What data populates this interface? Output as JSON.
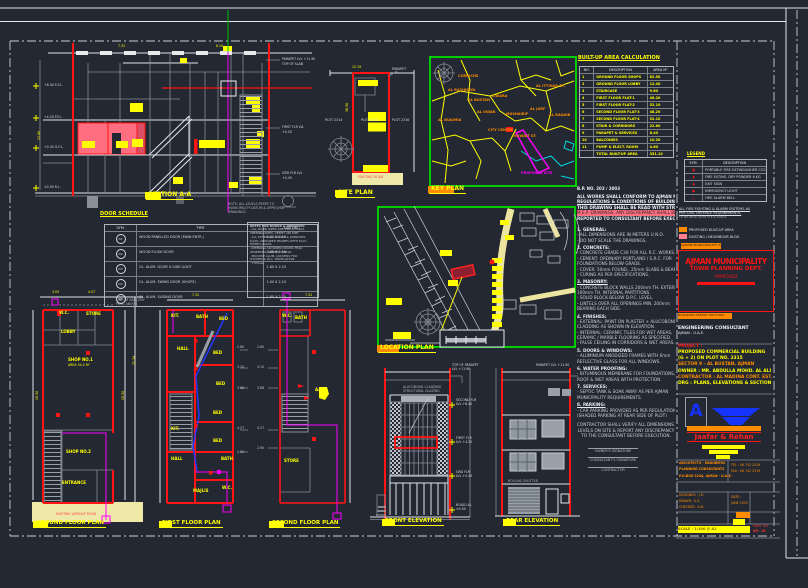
{
  "colors": {
    "background": "#232832",
    "cad_red": "#ff1414",
    "cad_yellow": "#ffff00",
    "cad_magenta": "#ff00ff",
    "cad_green": "#00cc00",
    "cad_cyan": "#00d8e0",
    "cad_orange": "#ff8c00",
    "cad_blue": "#2438ff",
    "road_fill": "#efe9a8"
  },
  "titles": {
    "section": "SECTION A-A",
    "site": "SITE PLAN",
    "key": "KEY PLAN",
    "location": "LOCATION PLAN",
    "ground": "GROUND FLOOR PLAN",
    "first": "FIRST FLOOR PLAN",
    "second": "SECOND FLOOR PLAN",
    "front": "FRONT ELEVATION",
    "rear": "REAR ELEVATION",
    "door_schedule": "DOOR SCHEDULE",
    "area_calc": "BUILT-UP AREA CALCULATION",
    "legend": "LEGEND"
  },
  "door_schedule": {
    "headers": [
      "SYM.",
      "TYPE",
      "SIZE (M)"
    ],
    "rows": [
      {
        "sym": "D1",
        "type": "WOOD PANELLED DOOR (MAIN ENTR.)",
        "size": "1.00 X 2.10"
      },
      {
        "sym": "D2",
        "type": "WOOD FLUSH DOOR",
        "size": "0.90 X 2.10"
      },
      {
        "sym": "D3",
        "type": "GL. ALUM. DOOR & SIDE LIGHT",
        "size": "1.80 X 2.10"
      },
      {
        "sym": "D4",
        "type": "GL. ALUM. SWING DOOR (SHOPS)",
        "size": "1.00 X 2.10"
      },
      {
        "sym": "D5",
        "type": "GL. ALUM. SLIDING DOOR",
        "size": "1.80 X 2.10"
      }
    ]
  },
  "door_notes": {
    "lines": [
      {
        "t": "NOTES FOR DOORS & WINDOWS:",
        "cls": "h"
      },
      {
        "t": "- ALL DOOR SIZES ARE STRUCTURAL",
        "cls": ""
      },
      {
        "t": "  OPENING SIZES. VERIFY ON SITE.",
        "cls": ""
      },
      {
        "t": "- ALL EXTERNAL DOORS & WINDOWS",
        "cls": ""
      },
      {
        "t": "  ALUM. ANODIZED FRAMES WITH 6mm",
        "cls": ""
      },
      {
        "t": "  TINTED GLASS.",
        "cls": ""
      },
      {
        "t": "- INTERNAL WOODEN DOORS TEAK",
        "cls": ""
      },
      {
        "t": "  VENEERED, PAINTED FINISH.",
        "cls": ""
      },
      {
        "t": "- PROVIDE ALUM. LOUVERS FOR",
        "cls": ""
      },
      {
        "t": "  KITCHEN & W.C. VENTILATION.",
        "cls": ""
      },
      {
        "t": "        - TYPICAL",
        "cls": ""
      }
    ]
  },
  "area_table": {
    "headers": [
      "NO.",
      "DESCRIPTION",
      "AREA M²"
    ],
    "rows": [
      {
        "no": "1",
        "desc": "GROUND FLOOR SHOPS",
        "area": "82.50"
      },
      {
        "no": "2",
        "desc": "GROUND FLOOR LOBBY",
        "area": "12.40"
      },
      {
        "no": "3",
        "desc": "STAIRCASE",
        "area": "9.80"
      },
      {
        "no": "4",
        "desc": "FIRST FLOOR FLAT-1",
        "area": "48.20"
      },
      {
        "no": "5",
        "desc": "FIRST FLOOR FLAT-2",
        "area": "52.10"
      },
      {
        "no": "6",
        "desc": "SECOND FLOOR FLAT-3",
        "area": "48.20"
      },
      {
        "no": "7",
        "desc": "SECOND FLOOR FLAT-4",
        "area": "52.10"
      },
      {
        "no": "8",
        "desc": "STAIR & CORRIDORS",
        "area": "22.60"
      },
      {
        "no": "9",
        "desc": "PARAPET & SERVICES",
        "area": "8.40"
      },
      {
        "no": "10",
        "desc": "BALCONIES",
        "area": "10.20"
      },
      {
        "no": "11",
        "desc": "PUMP & ELECT. ROOM",
        "area": "4.60"
      },
      {
        "no": "",
        "desc": "TOTAL BUILT-UP AREA",
        "area": "351.10"
      }
    ]
  },
  "legend": {
    "headers": [
      "SYM.",
      "DESCRIPTION"
    ],
    "rows": [
      {
        "sym": "▣",
        "desc": "PORTABLE FIRE EXTINGUISHER CO2"
      },
      {
        "sym": "▮",
        "desc": "FIRE EXTING. DRY POWDER 6 KG"
      },
      {
        "sym": "◆",
        "desc": "EXIT SIGN"
      },
      {
        "sym": "●",
        "desc": "EMERGENCY LIGHT"
      },
      {
        "sym": "△",
        "desc": "FIRE ALARM BELL"
      }
    ]
  },
  "notes": {
    "bp": "B.P. NO. 203 / 2003",
    "lines": [
      {
        "t": "ALL WORKS SHALL CONFORM TO AJMAN MUNICIPALITY",
        "cls": "h"
      },
      {
        "t": "REGULATIONS & CONDITIONS OF BUILDING PERMIT.",
        "cls": "h"
      },
      {
        "t": "THIS DRAWING SHALL BE READ WITH STRUCTURAL &",
        "cls": "h"
      },
      {
        "t": "M.E.P. DRAWINGS. ANY DISCREPANCY SHALL BE",
        "cls": "mark"
      },
      {
        "t": "REPORTED TO CONSULTANT BEFORE EXECUTION.",
        "cls": "h"
      },
      {
        "t": "",
        "cls": "sp"
      },
      {
        "t": "1. GENERAL:",
        "cls": "n"
      },
      {
        "t": "- ALL DIMENSIONS ARE IN METERS U.N.O.",
        "cls": ""
      },
      {
        "t": "- DO NOT SCALE THE DRAWINGS.",
        "cls": ""
      },
      {
        "t": "2. CONCRETE:",
        "cls": "n"
      },
      {
        "t": "- CONCRETE GRADE C30 FOR ALL R.C. WORKS.",
        "cls": ""
      },
      {
        "t": "- CEMENT: ORDINARY PORTLAND / S.R.C. FOR",
        "cls": ""
      },
      {
        "t": "  FOUNDATIONS BELOW GRADE.",
        "cls": ""
      },
      {
        "t": "- COVER: 50mm FOUND., 25mm SLABS & BEAMS.",
        "cls": ""
      },
      {
        "t": "- CURING AS PER SPECIFICATIONS.",
        "cls": ""
      },
      {
        "t": "3. MASONRY:",
        "cls": "n"
      },
      {
        "t": "- CONCRETE BLOCK WALLS 200mm TH. EXTERNAL,",
        "cls": ""
      },
      {
        "t": "  100mm TH. INTERNAL PARTITIONS.",
        "cls": ""
      },
      {
        "t": "- SOLID BLOCK BELOW D.P.C. LEVEL.",
        "cls": ""
      },
      {
        "t": "- LINTELS OVER ALL OPENINGS MIN. 200mm",
        "cls": ""
      },
      {
        "t": "  BEARING EACH SIDE.",
        "cls": ""
      },
      {
        "t": "4. FINISHES:",
        "cls": "n"
      },
      {
        "t": "- EXTERNAL: PAINT ON PLASTER + ALUCOBOND",
        "cls": ""
      },
      {
        "t": "  CLADDING AS SHOWN IN ELEVATION.",
        "cls": ""
      },
      {
        "t": "- INTERNAL: CERAMIC TILES FOR WET AREAS,",
        "cls": ""
      },
      {
        "t": "  CERAMIC / MARBLE FLOORING AS SPECIFIED.",
        "cls": ""
      },
      {
        "t": "- FALSE CEILING IN CORRIDORS & WET AREAS.",
        "cls": ""
      },
      {
        "t": "5. DOORS & WINDOWS:",
        "cls": "n"
      },
      {
        "t": "- ALUMINIUM ANODIZED FRAMES WITH 6mm",
        "cls": ""
      },
      {
        "t": "  REFLECTIVE GLASS FOR ALL WINDOWS.",
        "cls": ""
      },
      {
        "t": "6. WATER PROOFING:",
        "cls": "n"
      },
      {
        "t": "- BITUMINOUS MEMBRANE FOR FOUNDATIONS,",
        "cls": ""
      },
      {
        "t": "  ROOF & WET AREAS WITH PROTECTION.",
        "cls": ""
      },
      {
        "t": "7. SERVICES:",
        "cls": "n"
      },
      {
        "t": "- SEPTIC TANK & SOAK AWAY AS PER AJMAN",
        "cls": ""
      },
      {
        "t": "  MUNICIPALITY REQUIREMENTS.",
        "cls": ""
      },
      {
        "t": "8. PARKING:",
        "cls": "n"
      },
      {
        "t": "- CAR PARKING PROVIDED AS PER REGULATIONS.",
        "cls": ""
      },
      {
        "t": "  (SHADED PARKING AT REAR SIDE OF PLOT)",
        "cls": ""
      },
      {
        "t": "",
        "cls": "sp"
      },
      {
        "t": "CONTRACTOR SHALL VERIFY ALL DIMENSIONS &",
        "cls": "c"
      },
      {
        "t": "LEVELS ON SITE & REPORT ANY DISCREPANCY",
        "cls": "c"
      },
      {
        "t": "TO THE CONSULTANT BEFORE EXECUTION.",
        "cls": "c"
      }
    ]
  },
  "signature": {
    "lines": [
      "OWNER'S SIGNATURE",
      "CONSULTANT'S SIGNATURE",
      "CONTRACTOR"
    ]
  },
  "key_labels": [
    {
      "x": 448,
      "y": 88,
      "t": "AL RASHIDIYA"
    },
    {
      "x": 468,
      "y": 98,
      "t": "AL BUSTAN"
    },
    {
      "x": 492,
      "y": 94,
      "t": "LIWARA"
    },
    {
      "x": 477,
      "y": 110,
      "t": "AL OWAN"
    },
    {
      "x": 438,
      "y": 118,
      "t": "AL NUAIMIA"
    },
    {
      "x": 506,
      "y": 112,
      "t": "MUSHAIRIF"
    },
    {
      "x": 530,
      "y": 107,
      "t": "AL JURF"
    },
    {
      "x": 549,
      "y": 113,
      "t": "AL RAQAIB"
    },
    {
      "x": 488,
      "y": 128,
      "t": "CITY CENTRE"
    },
    {
      "x": 514,
      "y": 134,
      "t": "KUWAIT ST."
    },
    {
      "x": 536,
      "y": 84,
      "t": "AL ITTIHAD ST."
    },
    {
      "x": 458,
      "y": 74,
      "t": "CORNICHE"
    },
    {
      "x": 521,
      "y": 171,
      "t": "PROPOSED SITE",
      "c": "#ff00ff"
    }
  ],
  "title_block": {
    "note_lines": [
      {
        "t": "ALL FIRE FIGHTING & ALARM SYSTEMS AS",
        "cls": "h"
      },
      {
        "t": "PER CIVIL DEFENCE REQUIREMENTS.",
        "cls": "h"
      },
      {
        "t": "TO BE READ WITH M.E.P. DWGS.",
        "cls": "dim"
      }
    ],
    "swatches": [
      {
        "label": "PROPOSED BUILT-UP AREA",
        "bg": "#ff8c00"
      },
      {
        "label": "EXISTING / NEIGHBOUR BLDG.",
        "bg": "#ff8090"
      }
    ],
    "approval": "AJMAN MUNICIPALITY APPROVAL",
    "stamp": {
      "l1": "AJMAN MUNICIPALITY",
      "l2": "TOWN PLANNING DEPT.",
      "l3": "APPROVED"
    },
    "approval2": "BUILDING PERMIT SECTION",
    "firm": {
      "l1": "ENGINEERING CONSULTANT",
      "l2": "AJMAN - U.A.E."
    },
    "project_lines": [
      {
        "t": "PROJECT :",
        "c": "#ff2020"
      },
      {
        "t": "PROPOSED COMMERCIAL BUILDING",
        "c": "#ffff00"
      },
      {
        "t": "(G + 2) ON PLOT NO. 2315",
        "c": "#ffff00"
      },
      {
        "t": "SECTOR 9 - AL BUSTAN, AJMAN",
        "c": "#ff8c00"
      },
      {
        "t": "OWNER : MR. ABDULLA MOHD. AL ALI",
        "c": "#ffff00"
      },
      {
        "t": "CONTRACTOR : AL MADINA CONT. EST.",
        "c": "#ff8c00"
      },
      {
        "t": "DRG : PLANS, ELEVATIONS & SECTION",
        "c": "#ffff00"
      }
    ],
    "logo_letter": "A",
    "name": "Jaafar & Rehan",
    "scale_text": "SCALE : 1:100 @ A1"
  },
  "micro_texts": [
    {
      "x": 282,
      "y": 58,
      "t": "PARAPET LVL +11.90",
      "cls": "f3"
    },
    {
      "x": 282,
      "y": 63,
      "t": "TOP OF SLAB",
      "cls": "f3"
    },
    {
      "x": 282,
      "y": 126,
      "t": "FIRST FLR LVL",
      "cls": "f3"
    },
    {
      "x": 282,
      "y": 131,
      "t": "+4.20",
      "cls": "f3"
    },
    {
      "x": 282,
      "y": 172,
      "t": "GRD FLR LVL",
      "cls": "f3"
    },
    {
      "x": 282,
      "y": 177,
      "t": "+0.45",
      "cls": "f3"
    },
    {
      "x": 44,
      "y": 84,
      "t": "+8.40 S.F.L.",
      "cls": "f3"
    },
    {
      "x": 44,
      "y": 116,
      "t": "+4.20 F.F.L.",
      "cls": "f3"
    },
    {
      "x": 44,
      "y": 146,
      "t": "+0.45 G.F.L.",
      "cls": "f3"
    },
    {
      "x": 44,
      "y": 186,
      "t": "±0.00 R.L.",
      "cls": "f3"
    },
    {
      "x": 228,
      "y": 203,
      "t": "NOTE: ALL LEVELS REFER TO",
      "c": "#aeb4bc",
      "cls": "f3"
    },
    {
      "x": 228,
      "y": 207,
      "t": "MUNICIPALITY DATUM & APPROVED",
      "c": "#aeb4bc",
      "cls": "f3"
    },
    {
      "x": 228,
      "y": 211,
      "t": "DRAWINGS.",
      "c": "#aeb4bc",
      "cls": "f3"
    },
    {
      "x": 118,
      "y": 45,
      "t": "7.32",
      "c": "#ffff00",
      "cls": "f3"
    },
    {
      "x": 216,
      "y": 45,
      "t": "6.10",
      "c": "#ffff00",
      "cls": "f3"
    },
    {
      "x": 38,
      "y": 140,
      "t": "12.60",
      "c": "#ffff00",
      "cls": "f3 rot"
    },
    {
      "x": 325,
      "y": 119,
      "t": "PLOT 2314",
      "cls": "f3"
    },
    {
      "x": 361,
      "y": 119,
      "t": "PLOT 2315",
      "cls": "f3"
    },
    {
      "x": 392,
      "y": 119,
      "t": "PLOT 2316",
      "cls": "f3"
    },
    {
      "x": 392,
      "y": 68,
      "t": "PARAPET",
      "cls": "f3"
    },
    {
      "x": 358,
      "y": 176,
      "t": "EXISTING ROAD",
      "c": "#ff4040",
      "cls": "f3"
    },
    {
      "x": 352,
      "y": 66,
      "t": "12.19",
      "c": "#ffff00",
      "cls": "f3"
    },
    {
      "x": 346,
      "y": 112,
      "t": "36.58",
      "c": "#ffff00",
      "cls": "f3 rot"
    },
    {
      "x": 52,
      "y": 291,
      "t": "3.05",
      "c": "#ffff00",
      "cls": "f3"
    },
    {
      "x": 88,
      "y": 291,
      "t": "4.57",
      "c": "#ffff00",
      "cls": "f3"
    },
    {
      "x": 59,
      "y": 311,
      "t": "W.C.",
      "c": "#ffff00",
      "cls": "b"
    },
    {
      "x": 86,
      "y": 312,
      "t": "STORE",
      "c": "#ffff00",
      "cls": "b"
    },
    {
      "x": 61,
      "y": 330,
      "t": "LOBBY",
      "c": "#ffff00",
      "cls": "b"
    },
    {
      "x": 68,
      "y": 358,
      "t": "SHOP NO.1",
      "c": "#ffff00",
      "cls": "b"
    },
    {
      "x": 68,
      "y": 364,
      "t": "AREA 54.0 M²",
      "c": "#ffff00",
      "cls": "f3"
    },
    {
      "x": 66,
      "y": 450,
      "t": "SHOP NO.2",
      "c": "#ffff00",
      "cls": "b"
    },
    {
      "x": 62,
      "y": 481,
      "t": "ENTRANCE",
      "c": "#ffff00",
      "cls": "b"
    },
    {
      "x": 56,
      "y": 513,
      "t": "EXISTING ASPHALT ROAD",
      "c": "#ff4040",
      "cls": "f3"
    },
    {
      "x": 36,
      "y": 400,
      "t": "19.50",
      "c": "#ffff00",
      "cls": "f3 rot"
    },
    {
      "x": 122,
      "y": 400,
      "t": "19.50",
      "c": "#ffff00",
      "cls": "f3 rot"
    },
    {
      "x": 133,
      "y": 365,
      "t": "21.34",
      "c": "#ffff00",
      "cls": "f3 rot"
    },
    {
      "x": 116,
      "y": 299,
      "t": "LINE OF BALCONY",
      "c": "#aeb4bc",
      "cls": "f3"
    },
    {
      "x": 116,
      "y": 303,
      "t": "PROJ. ABOVE",
      "c": "#aeb4bc",
      "cls": "f3"
    },
    {
      "x": 192,
      "y": 294,
      "t": "7.32",
      "c": "#ffff00",
      "cls": "f3"
    },
    {
      "x": 171,
      "y": 314,
      "t": "KIT.",
      "c": "#ffff00",
      "cls": "b"
    },
    {
      "x": 196,
      "y": 315,
      "t": "BATH",
      "c": "#ffff00",
      "cls": "b"
    },
    {
      "x": 219,
      "y": 317,
      "t": "BED",
      "c": "#ffff00",
      "cls": "b"
    },
    {
      "x": 177,
      "y": 347,
      "t": "HALL",
      "c": "#ffff00",
      "cls": "b"
    },
    {
      "x": 213,
      "y": 351,
      "t": "BED",
      "c": "#ffff00",
      "cls": "b"
    },
    {
      "x": 216,
      "y": 382,
      "t": "BED",
      "c": "#ffff00",
      "cls": "b"
    },
    {
      "x": 213,
      "y": 411,
      "t": "BED",
      "c": "#ffff00",
      "cls": "b"
    },
    {
      "x": 171,
      "y": 427,
      "t": "KIT.",
      "c": "#ffff00",
      "cls": "b"
    },
    {
      "x": 213,
      "y": 439,
      "t": "BED",
      "c": "#ffff00",
      "cls": "b"
    },
    {
      "x": 171,
      "y": 457,
      "t": "HALL",
      "c": "#ffff00",
      "cls": "b"
    },
    {
      "x": 221,
      "y": 457,
      "t": "BATH",
      "c": "#ffff00",
      "cls": "b"
    },
    {
      "x": 193,
      "y": 489,
      "t": "MAJLIS",
      "c": "#ffff00",
      "cls": "b"
    },
    {
      "x": 222,
      "y": 486,
      "t": "W.C.",
      "c": "#ffff00",
      "cls": "b"
    },
    {
      "x": 237,
      "y": 346,
      "t": "2.80",
      "c": "#c2c8ce",
      "cls": "f3"
    },
    {
      "x": 237,
      "y": 366,
      "t": "3.10",
      "c": "#c2c8ce",
      "cls": "f3"
    },
    {
      "x": 237,
      "y": 387,
      "t": "3.66",
      "c": "#c2c8ce",
      "cls": "f3"
    },
    {
      "x": 237,
      "y": 427,
      "t": "4.27",
      "c": "#c2c8ce",
      "cls": "f3"
    },
    {
      "x": 237,
      "y": 451,
      "t": "2.90",
      "c": "#c2c8ce",
      "cls": "f3"
    },
    {
      "x": 305,
      "y": 294,
      "t": "7.32",
      "c": "#ffff00",
      "cls": "f3"
    },
    {
      "x": 282,
      "y": 314,
      "t": "W.C.",
      "c": "#ffff00",
      "cls": "b"
    },
    {
      "x": 295,
      "y": 316,
      "t": "BATH",
      "c": "#ffff00",
      "cls": "b"
    },
    {
      "x": 315,
      "y": 388,
      "t": "A/C",
      "c": "#ffff00",
      "cls": "b"
    },
    {
      "x": 284,
      "y": 459,
      "t": "STORE",
      "c": "#ffff00",
      "cls": "b"
    },
    {
      "x": 257,
      "y": 346,
      "t": "2.80",
      "c": "#c2c8ce",
      "cls": "f3"
    },
    {
      "x": 257,
      "y": 366,
      "t": "3.10",
      "c": "#c2c8ce",
      "cls": "f3"
    },
    {
      "x": 257,
      "y": 387,
      "t": "3.66",
      "c": "#c2c8ce",
      "cls": "f3"
    },
    {
      "x": 257,
      "y": 427,
      "t": "4.27",
      "c": "#c2c8ce",
      "cls": "f3"
    },
    {
      "x": 257,
      "y": 447,
      "t": "2.90",
      "c": "#c2c8ce",
      "cls": "f3"
    },
    {
      "x": 452,
      "y": 364,
      "t": "TOP OF PARAPET",
      "cls": "f3"
    },
    {
      "x": 452,
      "y": 368,
      "t": "LVL +11.90",
      "cls": "f3"
    },
    {
      "x": 456,
      "y": 399,
      "t": "SECOND FLR",
      "cls": "f3"
    },
    {
      "x": 456,
      "y": 403,
      "t": "LVL +8.40",
      "cls": "f3"
    },
    {
      "x": 456,
      "y": 437,
      "t": "FIRST FLR",
      "cls": "f3"
    },
    {
      "x": 456,
      "y": 441,
      "t": "LVL +4.20",
      "cls": "f3"
    },
    {
      "x": 456,
      "y": 471,
      "t": "GRD FLR",
      "cls": "f3"
    },
    {
      "x": 456,
      "y": 475,
      "t": "LVL +0.45",
      "cls": "f3"
    },
    {
      "x": 456,
      "y": 504,
      "t": "ROAD LVL",
      "cls": "f3"
    },
    {
      "x": 456,
      "y": 508,
      "t": "±0.00",
      "cls": "f3"
    },
    {
      "x": 403,
      "y": 386,
      "t": "ALUCOBOND CLADDING",
      "c": "#aeb4bc",
      "cls": "f3"
    },
    {
      "x": 403,
      "y": 390,
      "t": "STRUCTURAL GLAZING",
      "c": "#aeb4bc",
      "cls": "f3"
    },
    {
      "x": 536,
      "y": 364,
      "t": "PARAPET LVL +11.90",
      "cls": "f3"
    },
    {
      "x": 508,
      "y": 480,
      "t": "ROLLING SHUTTER",
      "c": "#aeb4bc",
      "cls": "f3"
    },
    {
      "x": 577,
      "y": 187,
      "t": "B.P. NO. 203 / 2003",
      "c": "#e8ecf0",
      "cls": "b"
    },
    {
      "x": 679,
      "y": 462,
      "t": "ARCHITECTS - ENGINEERS",
      "c": "#ff8c00",
      "cls": "b f3"
    },
    {
      "x": 679,
      "y": 468,
      "t": "PLANNING CONSULTANTS",
      "c": "#ff8c00",
      "cls": "b f3"
    },
    {
      "x": 679,
      "y": 475,
      "t": "P.O.BOX 2244, AJMAN - U.A.E.",
      "c": "#ff8c00",
      "cls": "b f3"
    },
    {
      "x": 731,
      "y": 464,
      "t": "TEL : 06 742 2318",
      "c": "#ff8c00",
      "cls": "f3"
    },
    {
      "x": 731,
      "y": 470,
      "t": "FAX : 06 742 2319",
      "c": "#ff8c00",
      "cls": "f3"
    },
    {
      "x": 679,
      "y": 494,
      "t": "DESIGNED : J.R.",
      "c": "#ff8c00",
      "cls": "f3"
    },
    {
      "x": 679,
      "y": 500,
      "t": "DRAWN : S.K.",
      "c": "#ff8c00",
      "cls": "f3"
    },
    {
      "x": 679,
      "y": 506,
      "t": "CHECKED : A.M.",
      "c": "#ff8c00",
      "cls": "f3"
    },
    {
      "x": 731,
      "y": 496,
      "t": "DATE :",
      "c": "#ff8c00",
      "cls": "f3"
    },
    {
      "x": 731,
      "y": 502,
      "t": "JUNE 2003",
      "c": "#ff8c00",
      "cls": "f3"
    },
    {
      "x": 753,
      "y": 525,
      "t": "DWG. NO.",
      "c": "#ff3030",
      "cls": "f3"
    },
    {
      "x": 753,
      "y": 530,
      "t": "AR - 01",
      "c": "#ff3030",
      "cls": "b f3"
    }
  ]
}
